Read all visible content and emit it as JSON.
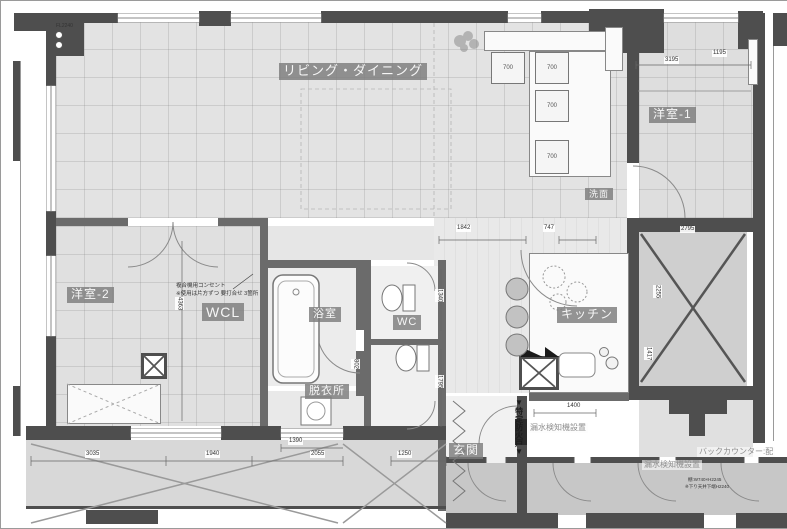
{
  "canvas": {
    "width": 787,
    "height": 527
  },
  "colors": {
    "wall": "#4e4e4e",
    "wall_medium": "#6b6b6b",
    "floor_light": "#e3e3e3",
    "corridor": "#c7c7c7",
    "balcony": "#d8d8d8",
    "label_chip_bg": "#8f8f8f",
    "label_chip_text": "#f6f6f6",
    "dimension_text": "#333333"
  },
  "room_labels": [
    {
      "name": "living-dining-label",
      "text": "リビング・ダイニング",
      "x": 278,
      "y": 62,
      "fs": 13
    },
    {
      "name": "bedroom-1-label",
      "text": "洋室-1",
      "x": 648,
      "y": 106,
      "fs": 12
    },
    {
      "name": "bedroom-2-label",
      "text": "洋室-2",
      "x": 66,
      "y": 286,
      "fs": 12
    },
    {
      "name": "walk-in-closet-label",
      "text": "WCL",
      "x": 201,
      "y": 302,
      "fs": 14
    },
    {
      "name": "bathroom-label",
      "text": "浴室",
      "x": 308,
      "y": 306,
      "fs": 11
    },
    {
      "name": "dressing-room-label",
      "text": "脱衣所",
      "x": 304,
      "y": 383,
      "fs": 11
    },
    {
      "name": "toilet-label",
      "text": "WC",
      "x": 392,
      "y": 314,
      "fs": 11
    },
    {
      "name": "kitchen-label",
      "text": "キッチン",
      "x": 556,
      "y": 306,
      "fs": 12
    },
    {
      "name": "washroom-label",
      "text": "洗面",
      "x": 584,
      "y": 187,
      "fs": 9
    },
    {
      "name": "entrance-label",
      "text": "玄関",
      "x": 448,
      "y": 442,
      "fs": 12
    }
  ],
  "notes": [
    {
      "name": "floor-level-note",
      "text": "FL2240",
      "x": 55,
      "y": 22,
      "fs": 5,
      "cls": ""
    },
    {
      "name": "outlet-note-line1",
      "text": "複合機用コンセント",
      "x": 175,
      "y": 282,
      "fs": 5.5,
      "cls": ""
    },
    {
      "name": "outlet-note-line2",
      "text": "※使用は片方ずつ 要打合せ 3箇所",
      "x": 175,
      "y": 290,
      "fs": 5.5,
      "cls": ""
    },
    {
      "name": "fire-door-note",
      "text": "▼特定防火戸▼",
      "x": 513,
      "y": 397,
      "fs": 8,
      "cls": "v bold"
    },
    {
      "name": "leak-detector-note-1",
      "text": "漏水検知機設置",
      "x": 527,
      "y": 422,
      "fs": 8,
      "cls": "gray"
    },
    {
      "name": "leak-detector-note-2",
      "text": "漏水検知機設置",
      "x": 641,
      "y": 459,
      "fs": 8,
      "cls": "gray"
    },
    {
      "name": "back-counter-note",
      "text": "バックカウンター:配",
      "x": 696,
      "y": 446,
      "fs": 8,
      "cls": "gray"
    },
    {
      "name": "shelf-note",
      "text": "棚:W740×H2245",
      "x": 687,
      "y": 476,
      "fs": 4.5,
      "cls": ""
    },
    {
      "name": "ceiling-note",
      "text": "※下り天井下端H2240",
      "x": 684,
      "y": 483,
      "fs": 4.5,
      "cls": ""
    }
  ],
  "dimensions": [
    {
      "name": "dim-3195",
      "text": "3195",
      "x": 663,
      "y": 56,
      "cls": ""
    },
    {
      "name": "dim-1195",
      "text": "1195",
      "x": 711,
      "y": 49,
      "cls": ""
    },
    {
      "name": "dim-2795",
      "text": "2795",
      "x": 679,
      "y": 225,
      "cls": ""
    },
    {
      "name": "dim-1842",
      "text": "1842",
      "x": 455,
      "y": 224,
      "cls": ""
    },
    {
      "name": "dim-747",
      "text": "747",
      "x": 542,
      "y": 224,
      "cls": ""
    },
    {
      "name": "dim-1400",
      "text": "1400",
      "x": 565,
      "y": 402,
      "cls": ""
    },
    {
      "name": "dim-4363",
      "text": "4363",
      "x": 174,
      "y": 296,
      "cls": "v"
    },
    {
      "name": "dim-1340",
      "text": "1340",
      "x": 434,
      "y": 288,
      "cls": "v"
    },
    {
      "name": "dim-1795",
      "text": "1795",
      "x": 434,
      "y": 374,
      "cls": "v"
    },
    {
      "name": "dim-802",
      "text": "802",
      "x": 350,
      "y": 358,
      "cls": "v"
    },
    {
      "name": "dim-2255",
      "text": "2255",
      "x": 652,
      "y": 284,
      "cls": "v"
    },
    {
      "name": "dim-1417",
      "text": "1417",
      "x": 643,
      "y": 346,
      "cls": "v"
    },
    {
      "name": "dim-3035",
      "text": "3035",
      "x": 84,
      "y": 450,
      "cls": ""
    },
    {
      "name": "dim-1940",
      "text": "1940",
      "x": 204,
      "y": 450,
      "cls": ""
    },
    {
      "name": "dim-2055",
      "text": "2055",
      "x": 309,
      "y": 450,
      "cls": ""
    },
    {
      "name": "dim-1390",
      "text": "1390",
      "x": 287,
      "y": 437,
      "cls": ""
    },
    {
      "name": "dim-1250",
      "text": "1250",
      "x": 396,
      "y": 450,
      "cls": ""
    }
  ],
  "storage_boxes": [
    {
      "name": "storage-box-700-1",
      "text": "700",
      "x": 490,
      "y": 51,
      "w": 34,
      "h": 32
    },
    {
      "name": "storage-box-700-2",
      "text": "700",
      "x": 534,
      "y": 51,
      "w": 34,
      "h": 32
    },
    {
      "name": "storage-box-700-3",
      "text": "700",
      "x": 534,
      "y": 89,
      "w": 34,
      "h": 32
    },
    {
      "name": "storage-box-700-4",
      "text": "700",
      "x": 534,
      "y": 139,
      "w": 34,
      "h": 34
    }
  ]
}
